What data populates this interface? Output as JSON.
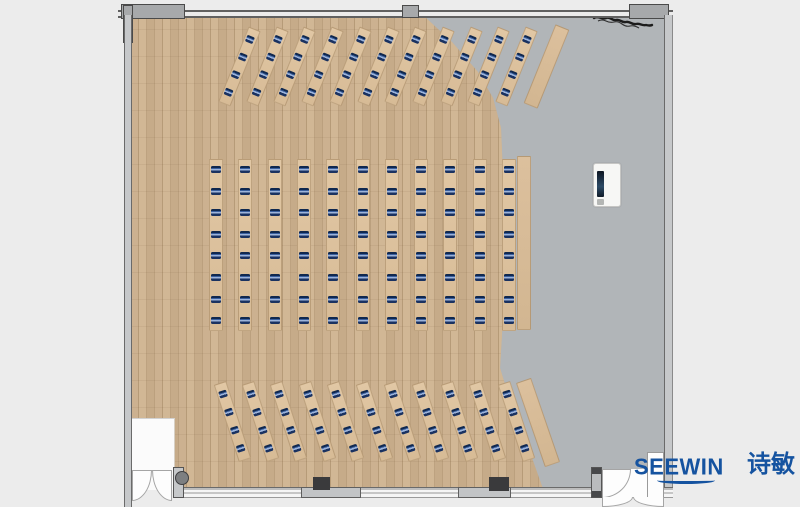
{
  "meta": {
    "title": "Classroom / training-room furniture floor plan (top view render)",
    "background_outside": "#ececec"
  },
  "brand": {
    "name_en": "SEEWIN",
    "name_zh": "诗敏",
    "color": "#1553a0"
  },
  "palette": {
    "floor_gray": "#b1b5b8",
    "floor_wood": "#c7ac8a",
    "desk_top": "#ddc29e",
    "seat_marker_navy": "#16325f",
    "wall_gray": "#c6c8ca",
    "wall_column_dark": "#3a3a3c"
  },
  "furniture": {
    "top_section": {
      "desk_rows": 11,
      "seats_per_row": 4,
      "sideboards": 1,
      "tilt_deg": 22
    },
    "middle_section": {
      "desk_rows": 11,
      "seats_per_row": 8,
      "sideboards": 1,
      "tilt_deg": 0
    },
    "bottom_section": {
      "desk_rows": 11,
      "seats_per_row": 4,
      "sideboards": 1,
      "tilt_deg": -18
    },
    "total_seats": 176,
    "podium": {
      "label": "lectern-with-screen"
    }
  },
  "architecture": {
    "doors": [
      {
        "label": "double-door-bottom-left"
      },
      {
        "label": "double-door-bottom-right"
      }
    ],
    "wall_columns": 2,
    "plan_note_mark": "scribble-top-right"
  }
}
